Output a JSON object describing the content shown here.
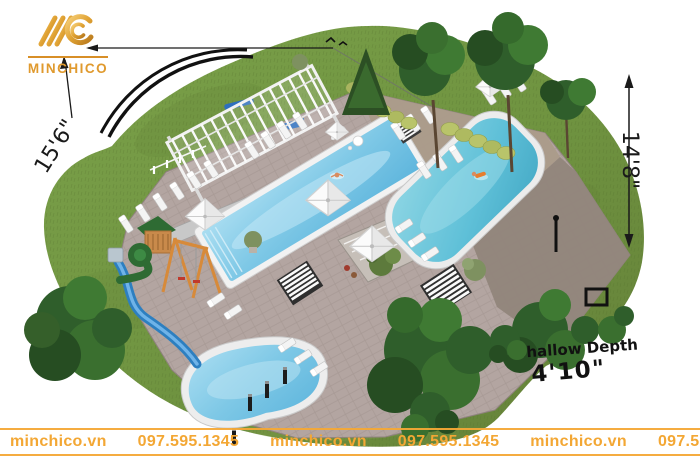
{
  "brand": {
    "name": "MINCHICO"
  },
  "annotations": {
    "left_dimension": "15'6\"",
    "right_dimension": "14'8\"",
    "depth_label": "Shallow Depth",
    "depth_value": "4'10\""
  },
  "watermark": {
    "items": [
      "minchico.vn",
      "097.595.1345",
      "minchico.vn",
      "097.595.1345",
      "minchico.vn",
      "097.595.1345"
    ]
  },
  "palette": {
    "logo_gold": "#E09A2E",
    "watermark_orange": "#F3A734",
    "grass_green": "#71943F",
    "deck_mauve": "#B3A5A1",
    "terrace_tan": "#AB9B8A",
    "driveway_taupe": "#91857B",
    "pool_blue": "#7EC8E6",
    "pool_teal": "#5FC0D8",
    "annotation_black": "#1A1A1A"
  }
}
